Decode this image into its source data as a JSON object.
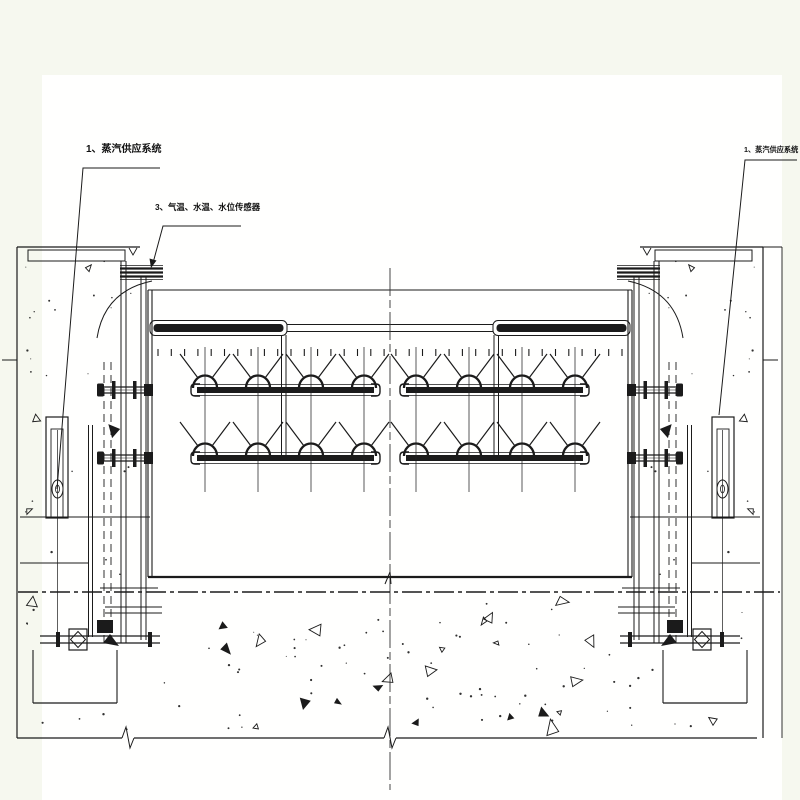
{
  "colors": {
    "page_bg": "#f6f8ef",
    "canvas_bg": "#fffffe",
    "ink": "#1b1b1b",
    "soft_line": "#333333"
  },
  "labels": {
    "steam_left": "1、蒸汽供应系统",
    "sensors": "3、气温、水温、水位传感器",
    "steam_right": "1、蒸汽供应系统"
  }
}
